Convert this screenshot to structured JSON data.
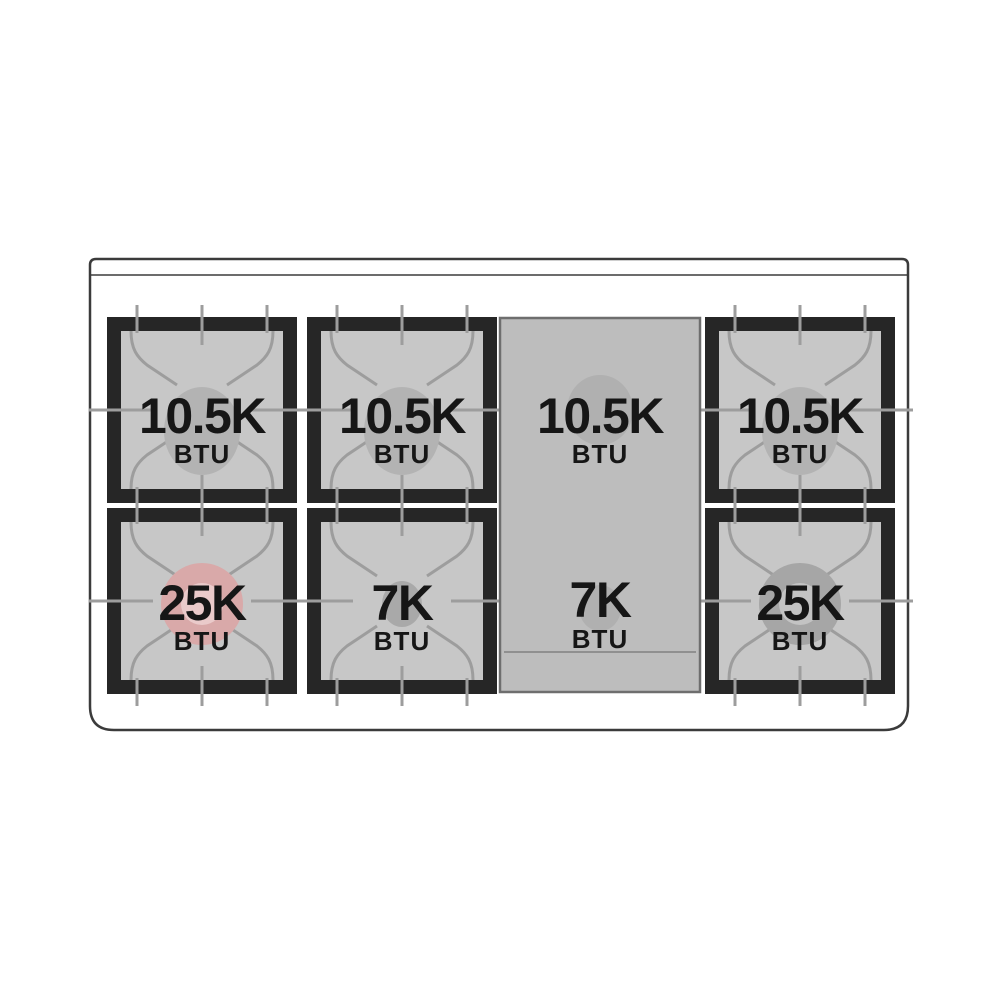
{
  "diagram": {
    "subject": "gas-range-cooktop-burner-layout",
    "burner_count": 6,
    "rows": 2,
    "has_center_griddle": true
  },
  "colors": {
    "background": "#ffffff",
    "cooktop_outline": "#3b3b3b",
    "grate_frame": "#262626",
    "grate_surface": "#c7c7c7",
    "grate_lines": "#9d9d9d",
    "burner_cap_gray": "#b3b3b3",
    "small_burner_cap": "#a9a9a9",
    "power_burner_ring": "#a6a6a6",
    "power_burner_inner": "#c3c3c3",
    "power_burner_highlight": "#d9a9a9",
    "power_burner_highlight_inner": "#eacaca",
    "griddle_surface": "#bdbdbd",
    "griddle_border": "#6e6e6e",
    "griddle_burner_cap": "#b0b0b0",
    "griddle_edge_line": "#8a8a8a",
    "label_text": "#161616"
  },
  "burners": {
    "top_left": {
      "rating": "10.5K",
      "unit": "BTU"
    },
    "top_center": {
      "rating": "10.5K",
      "unit": "BTU"
    },
    "griddle_top": {
      "rating": "10.5K",
      "unit": "BTU"
    },
    "top_right": {
      "rating": "10.5K",
      "unit": "BTU"
    },
    "bottom_left": {
      "rating": "25K",
      "unit": "BTU"
    },
    "bottom_center": {
      "rating": "7K",
      "unit": "BTU"
    },
    "griddle_bottom": {
      "rating": "7K",
      "unit": "BTU"
    },
    "bottom_right": {
      "rating": "25K",
      "unit": "BTU"
    }
  }
}
